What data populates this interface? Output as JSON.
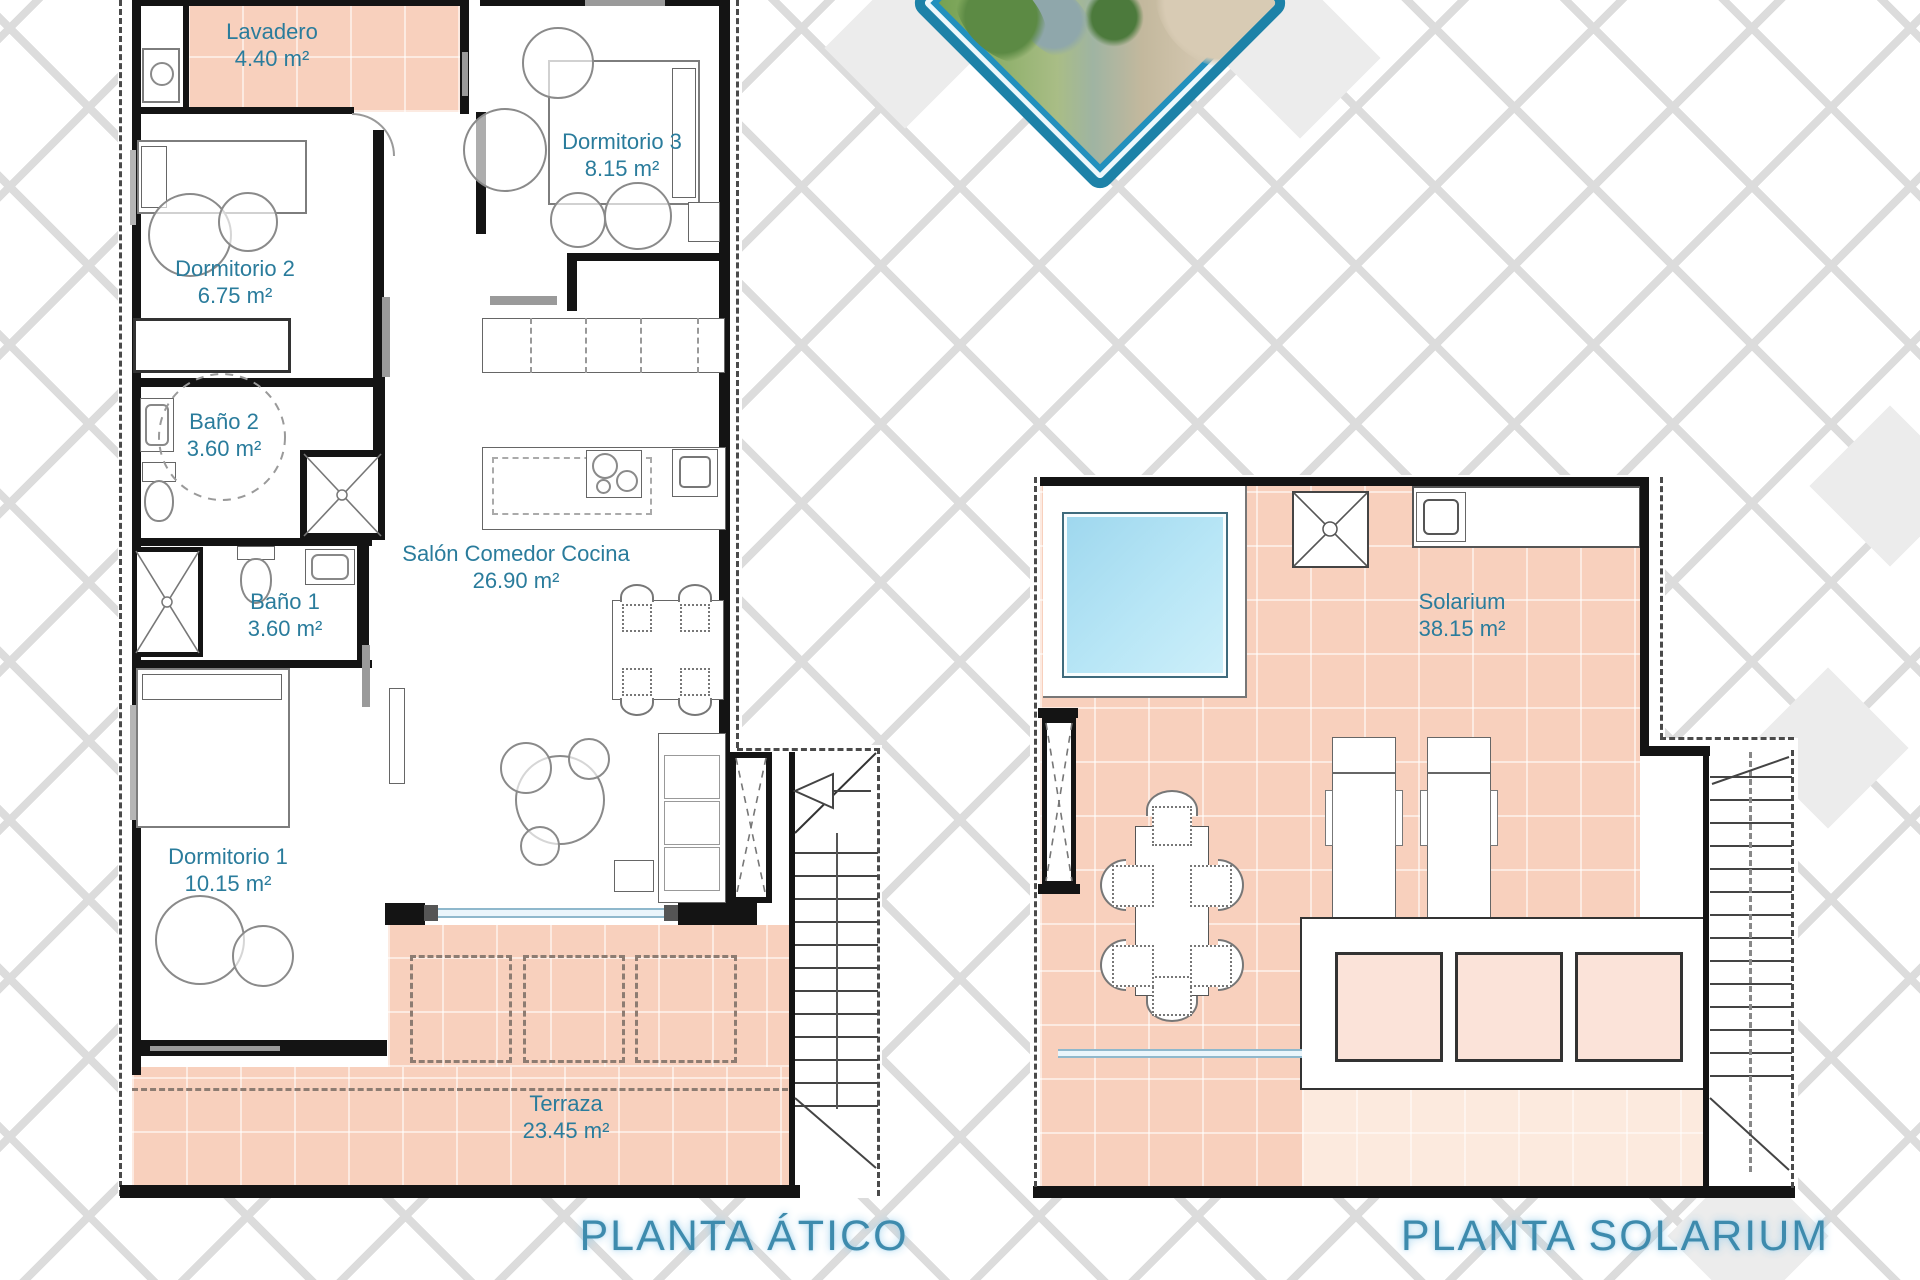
{
  "document": {
    "kind": "floor-plan-sheet"
  },
  "plans": {
    "atico": {
      "title": "PLANTA ÁTICO",
      "rooms": {
        "lavadero": {
          "name": "Lavadero",
          "area": "4.40 m²"
        },
        "dormitorio2": {
          "name": "Dormitorio 2",
          "area": "6.75 m²"
        },
        "dormitorio3": {
          "name": "Dormitorio 3",
          "area": "8.15 m²"
        },
        "bano2": {
          "name": "Baño 2",
          "area": "3.60 m²"
        },
        "bano1": {
          "name": "Baño 1",
          "area": "3.60 m²"
        },
        "salon": {
          "name": "Salón Comedor Cocina",
          "area": "26.90 m²"
        },
        "dormitorio1": {
          "name": "Dormitorio 1",
          "area": "10.15 m²"
        },
        "terraza": {
          "name": "Terraza",
          "area": "23.45 m²"
        }
      }
    },
    "solarium": {
      "title": "PLANTA SOLARIUM",
      "rooms": {
        "solarium": {
          "name": "Solarium",
          "area": "38.15 m²"
        }
      }
    }
  },
  "photo": {
    "name": "aerial-development-render"
  },
  "colors": {
    "label_teal": "#2a7c9c",
    "title_blue": "#3e8bad",
    "floor_pink": "#f8d0bd",
    "planter_pink": "#fbe3d9",
    "pool_blue": "#ade0f2",
    "wall_black": "#141414",
    "lattice_gray": "#dcdcdc",
    "photo_border_teal": "#1d82a8"
  }
}
